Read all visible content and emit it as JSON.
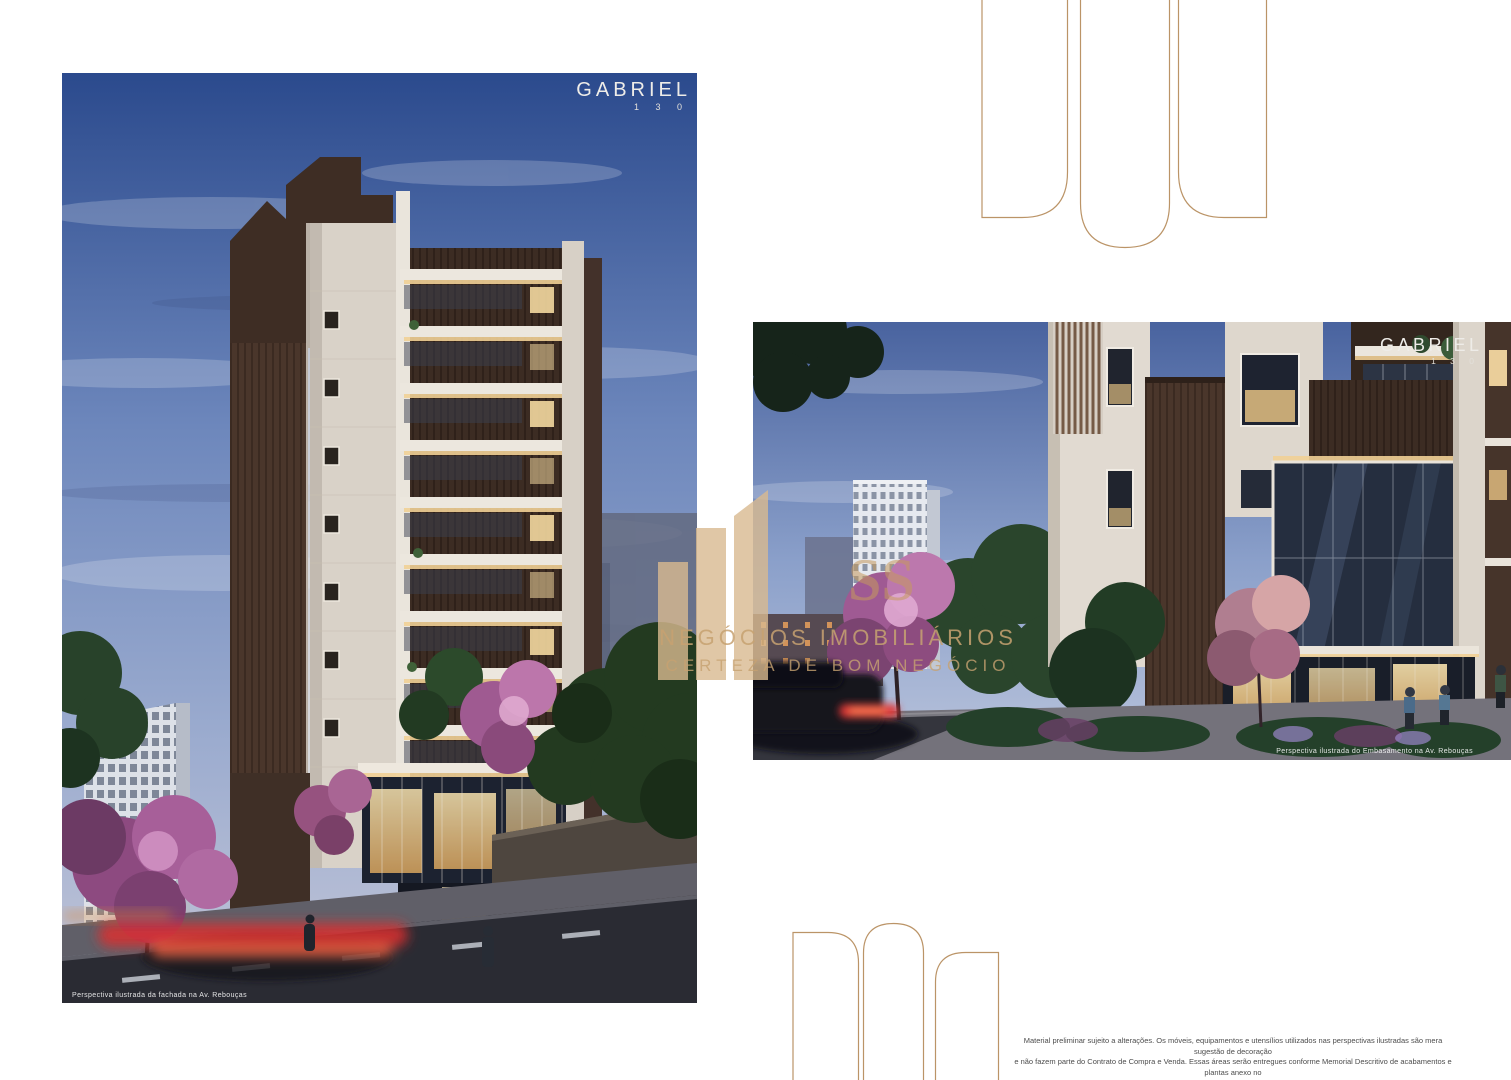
{
  "brand": {
    "name": "GABRIEL",
    "number": "1 3 0"
  },
  "renders": {
    "facade": {
      "caption": "Perspectiva ilustrada da fachada na Av. Rebouças"
    },
    "embasamento": {
      "caption": "Perspectiva ilustrada do Embasamento na Av. Rebouças"
    }
  },
  "watermark": {
    "letters": "SS",
    "line1": "NEGÓCIOS IMOBILIÁRIOS",
    "line2": "CERTEZA DE BOM NEGÓCIO"
  },
  "disclaimer": {
    "lines": [
      "Material preliminar sujeito a alterações. Os móveis, equipamentos e utensílios utilizados nas perspectivas ilustradas são mera sugestão de decoração",
      "e não fazem parte do Contrato de Compra e Venda. Essas áreas serão entregues conforme Memorial Descritivo de acabamentos e plantas anexo no",
      "contrato. O apartamento poderá sofrer pequenos ajustes decorrentes do desenvolvimento dos projetos executivos de estrutura, arquitetura e instalações,",
      "sem prévio aviso. As medidas dos ambientes são de face a face das paredes."
    ]
  },
  "colors": {
    "gold_outline": "#bb9467",
    "watermark_gold": "#d9ba90",
    "accent_brick": "#4a362b",
    "accent_purple": "#a05a94"
  }
}
